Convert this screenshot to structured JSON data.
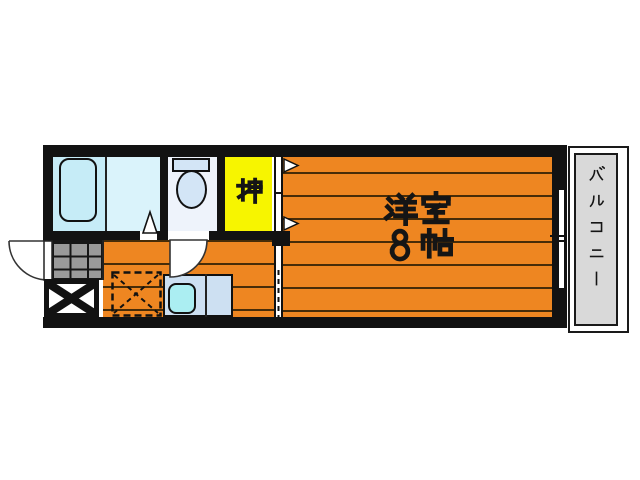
{
  "floorplan": {
    "labels": {
      "main_room_name": "洋室",
      "main_room_size": "8帖",
      "closet": "押",
      "balcony": "バルコニー"
    },
    "colors": {
      "paper": "#ffffff",
      "wall": "#121212",
      "flooring": "#ee8621",
      "plank-line": "#472c08",
      "closet": "#f7f500",
      "bathroom": "#c6ecf7",
      "washroom": "#daf3fb",
      "toilet-room": "#eef3fb",
      "toilet-fixture": "#d3e5f6",
      "counter": "#cde0f2",
      "sink": "#abeef2",
      "tile": "#9a9a9a",
      "balcony": "#d9d9d9"
    },
    "symbols": [
      {
        "name": "bathtub"
      },
      {
        "name": "bathroom-door-triangle"
      },
      {
        "name": "toilet"
      },
      {
        "name": "closet-sliding-door-arrows"
      },
      {
        "name": "entrance-door-arc"
      },
      {
        "name": "genkan-tiles"
      },
      {
        "name": "cross-hatch-box"
      },
      {
        "name": "refrigerator-space-dashed"
      },
      {
        "name": "kitchen-sink"
      },
      {
        "name": "toilet-door-arc"
      },
      {
        "name": "partition-dashed-line"
      },
      {
        "name": "balcony-sliding-window"
      }
    ]
  }
}
